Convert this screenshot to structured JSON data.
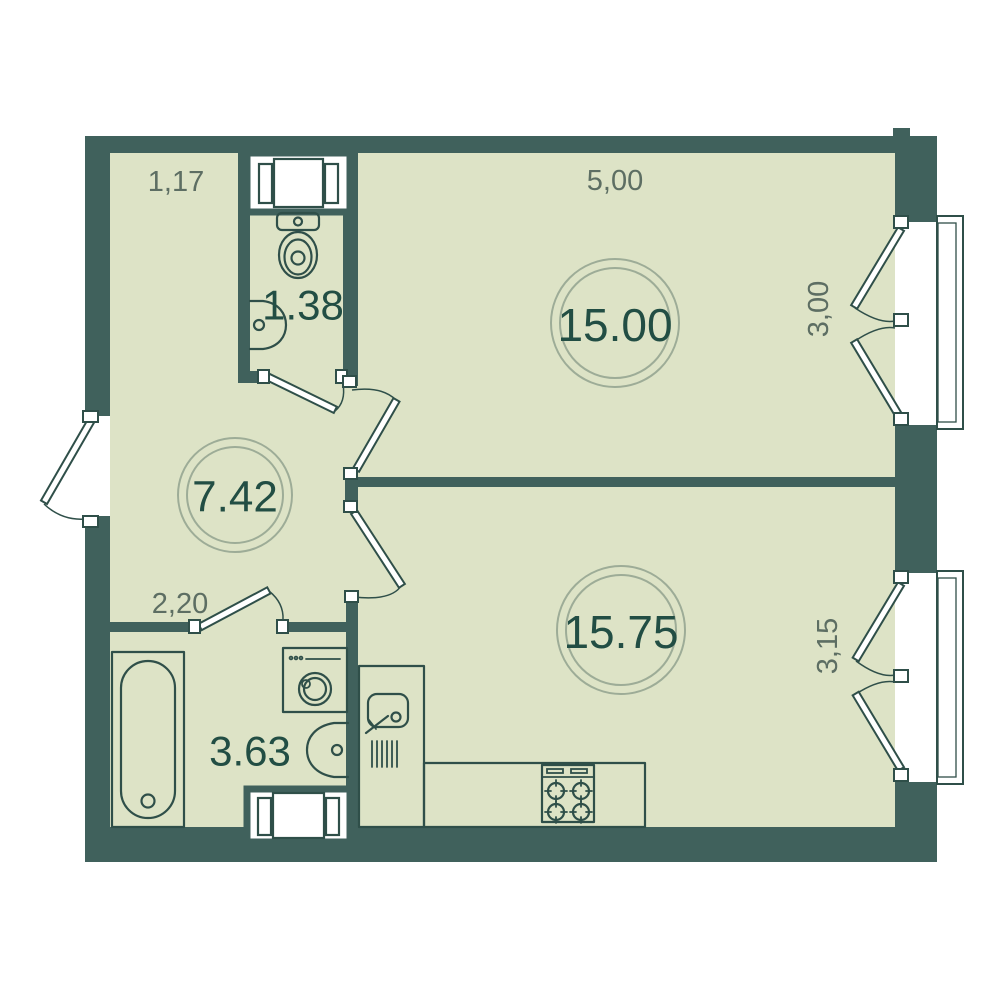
{
  "plan": {
    "type": "apartment-floor-plan",
    "background": "#ffffff",
    "colors": {
      "wall": "#40615c",
      "floor": "#dde3c6",
      "fixture_outline": "#2f4f49",
      "area_label_text": "#224e44",
      "dimension_label_text": "#5d6e63",
      "label_ring": "#9dac97",
      "door_window_fill": "#ffffff"
    },
    "rooms": [
      {
        "name": "living-room",
        "area": "15.00"
      },
      {
        "name": "kitchen-living-room",
        "area": "15.75"
      },
      {
        "name": "hallway",
        "area": "7.42"
      },
      {
        "name": "bathroom",
        "area": "3.63"
      },
      {
        "name": "wc",
        "area": "1.38"
      }
    ],
    "dimensions": [
      {
        "edge": "hallway-top-width",
        "value": "1,17"
      },
      {
        "edge": "living-room-width",
        "value": "5,00"
      },
      {
        "edge": "living-room-depth",
        "value": "3,00"
      },
      {
        "edge": "hallway-bottom-width",
        "value": "2,20"
      },
      {
        "edge": "kitchen-depth",
        "value": "3,15"
      }
    ]
  }
}
